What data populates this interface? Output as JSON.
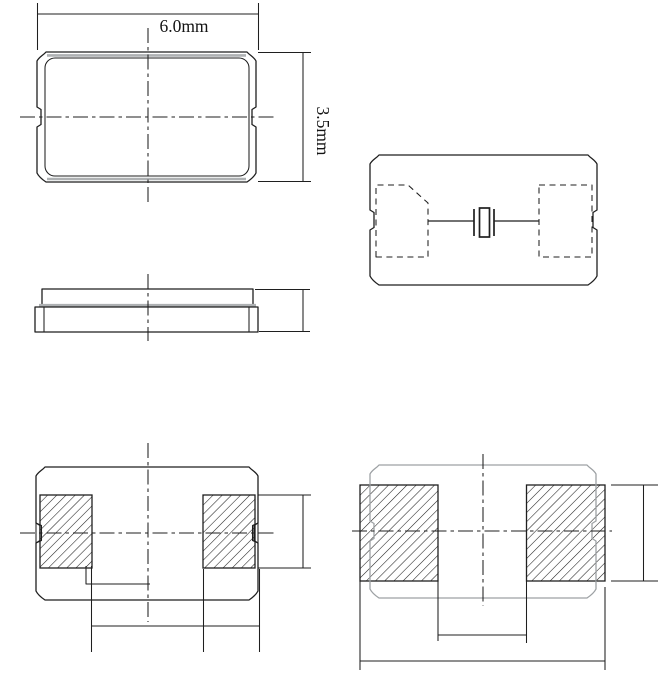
{
  "drawing": {
    "type": "mechanical-package-drawing",
    "labels": {
      "width": "6.0mm",
      "height": "3.5mm"
    },
    "colors": {
      "line": "#1f1f1f",
      "outline_gray": "#9da1a4",
      "seam_gray": "#aeb1b3",
      "background": "#ffffff"
    }
  }
}
